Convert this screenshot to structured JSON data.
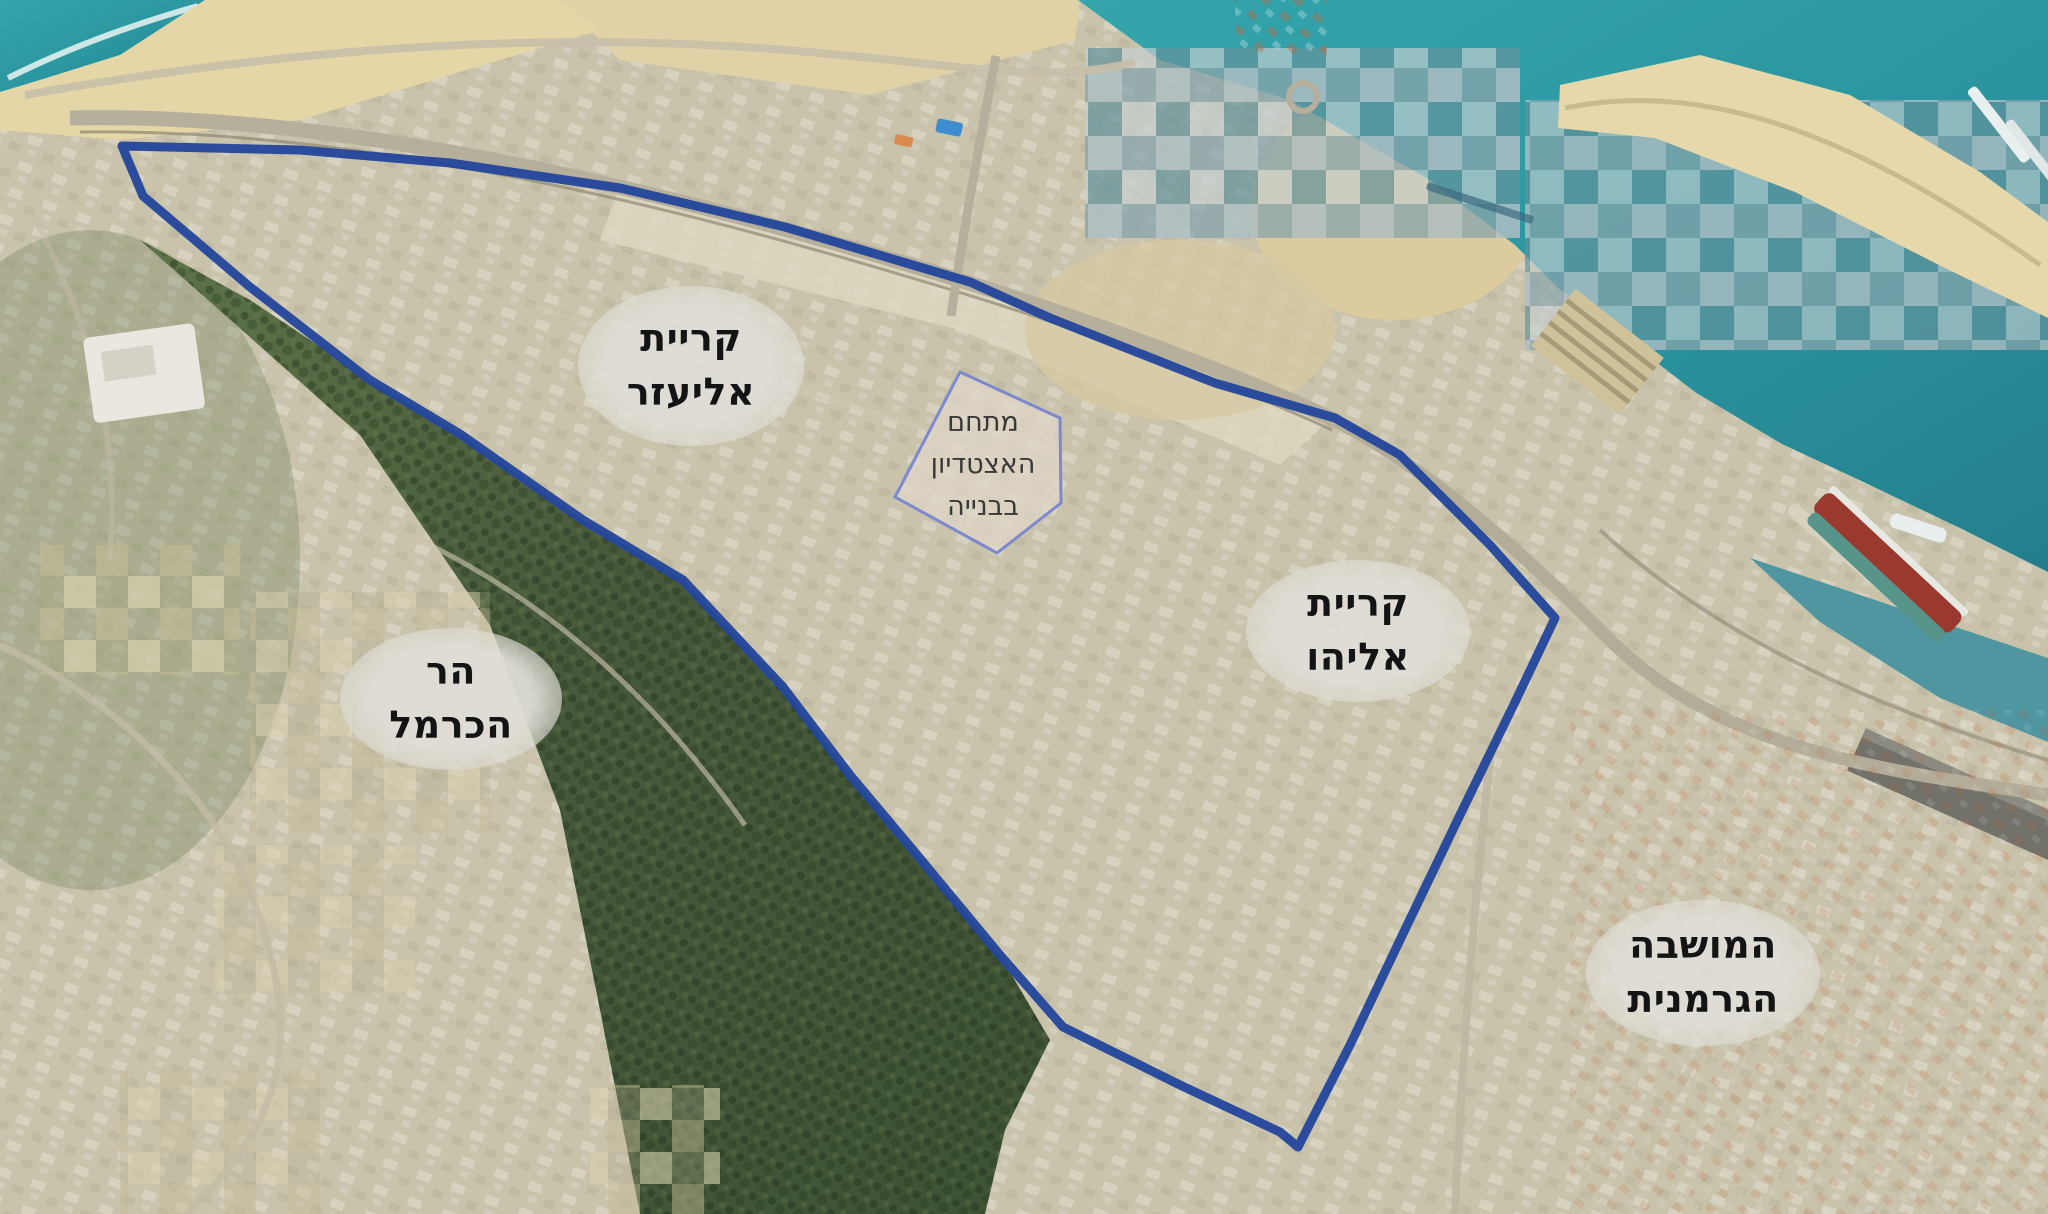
{
  "map": {
    "title": "aerial-map-haifa-stadium-area",
    "region_labels": [
      {
        "id": "kiryat-eliezer",
        "lines": [
          "קריית",
          "אליעזר"
        ]
      },
      {
        "id": "kiryat-eliyahu",
        "lines": [
          "קריית",
          "אליהו"
        ]
      },
      {
        "id": "har-hacarmel",
        "lines": [
          "הר",
          "הכרמל"
        ]
      },
      {
        "id": "hamoshava-hagermanit",
        "lines": [
          "המושבה",
          "הגרמנית"
        ]
      }
    ],
    "site_label": {
      "lines": [
        "מתחם",
        "האצטדיון",
        "בבנייה"
      ]
    },
    "colors": {
      "boundary_outline": "#24479c",
      "site_outline": "#7d88cf",
      "sea": "#2e9aa3",
      "forest": "#4e6340",
      "sand": "#e5d6a8",
      "urban": "#c9c3ab",
      "label_background": "#dfddd6",
      "label_text": "#141414"
    }
  }
}
